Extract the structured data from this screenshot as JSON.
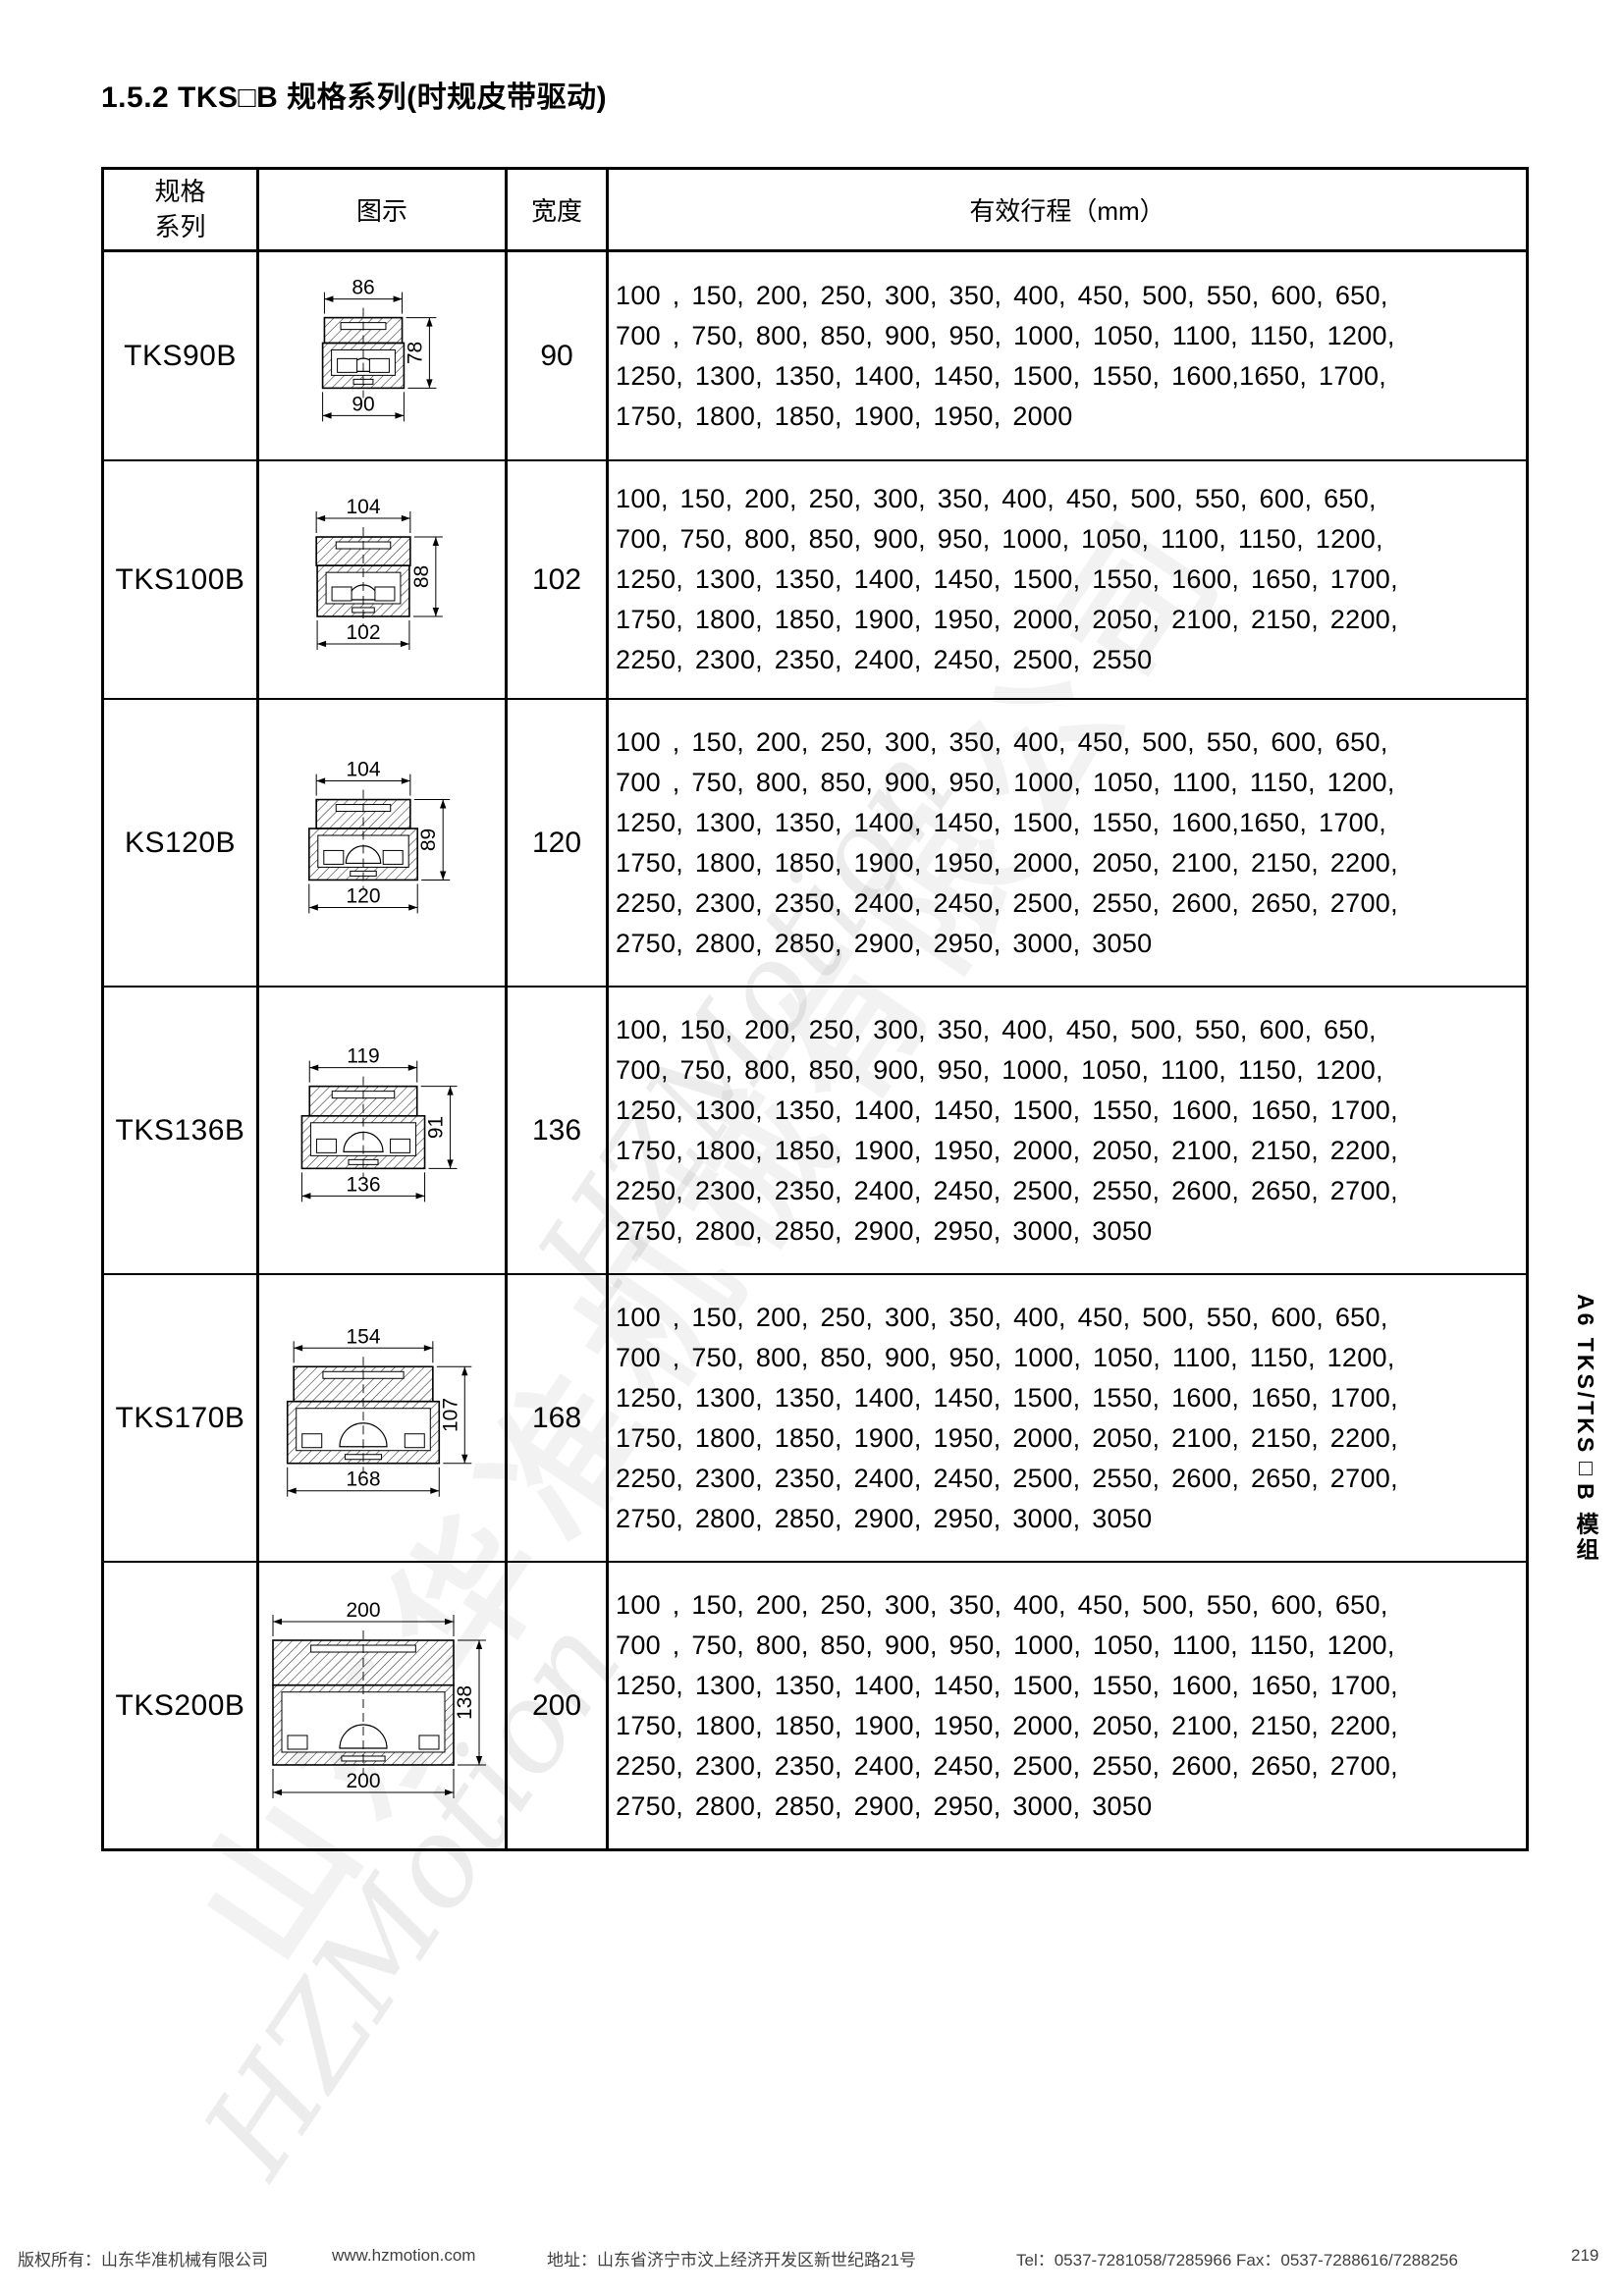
{
  "page": {
    "title": "1.5.2 TKS□B 规格系列(时规皮带驱动)",
    "sidebar_vertical_label": "A6 TKS/TKS□B 模组",
    "watermark": {
      "script_text": "HZMotion",
      "company_text": "山东华准机械有限公司"
    },
    "footer": {
      "copyright": "版权所有：山东华准机械有限公司",
      "website": "www.hzmotion.com",
      "address": "地址：山东省济宁市汶上经济开发区新世纪路21号",
      "tel_fax": "Tel：0537-7281058/7285966 Fax：0537-7288616/7288256",
      "page_number": "219"
    }
  },
  "table": {
    "headers": {
      "series": "规格\n系列",
      "diagram": "图示",
      "width": "宽度",
      "stroke": "有效行程（mm）"
    },
    "rows": [
      {
        "series": "TKS90B",
        "width": "90",
        "diagram": {
          "top_width": "86",
          "height": "78",
          "bottom_width": "90"
        },
        "stroke_lines": "100 , 150, 200, 250, 300, 350, 400, 450, 500, 550, 600, 650,\n700 , 750, 800, 850, 900, 950, 1000, 1050, 1100, 1150, 1200,\n1250, 1300, 1350, 1400, 1450, 1500, 1550, 1600,1650, 1700,\n1750, 1800, 1850, 1900, 1950, 2000"
      },
      {
        "series": "TKS100B",
        "width": "102",
        "diagram": {
          "top_width": "104",
          "height": "88",
          "bottom_width": "102"
        },
        "stroke_lines": "100, 150, 200, 250, 300, 350, 400, 450, 500, 550, 600, 650,\n700, 750, 800, 850, 900, 950, 1000, 1050, 1100, 1150, 1200,\n1250, 1300, 1350, 1400, 1450, 1500, 1550, 1600, 1650, 1700,\n1750, 1800, 1850, 1900, 1950, 2000, 2050, 2100, 2150, 2200,\n2250, 2300, 2350, 2400, 2450, 2500, 2550"
      },
      {
        "series": "KS120B",
        "width": "120",
        "diagram": {
          "top_width": "104",
          "height": "89",
          "bottom_width": "120"
        },
        "stroke_lines": "100 , 150, 200, 250, 300, 350, 400, 450, 500, 550, 600, 650,\n700 , 750, 800, 850, 900, 950, 1000, 1050, 1100, 1150, 1200,\n1250, 1300, 1350, 1400, 1450, 1500, 1550, 1600,1650, 1700,\n1750, 1800, 1850, 1900, 1950, 2000, 2050, 2100, 2150, 2200,\n2250, 2300, 2350, 2400, 2450, 2500, 2550, 2600, 2650, 2700,\n2750, 2800, 2850, 2900, 2950, 3000, 3050"
      },
      {
        "series": "TKS136B",
        "width": "136",
        "diagram": {
          "top_width": "119",
          "height": "91",
          "bottom_width": "136"
        },
        "stroke_lines": "100, 150, 200, 250, 300, 350, 400, 450, 500, 550, 600, 650,\n700, 750, 800, 850, 900, 950, 1000, 1050, 1100, 1150, 1200,\n1250, 1300, 1350, 1400, 1450, 1500, 1550, 1600, 1650, 1700,\n1750, 1800, 1850, 1900, 1950, 2000, 2050, 2100, 2150, 2200,\n2250, 2300, 2350, 2400, 2450, 2500, 2550, 2600, 2650, 2700,\n2750, 2800, 2850, 2900, 2950, 3000, 3050"
      },
      {
        "series": "TKS170B",
        "width": "168",
        "diagram": {
          "top_width": "154",
          "height": "107",
          "bottom_width": "168"
        },
        "stroke_lines": "100 , 150, 200, 250, 300, 350, 400, 450, 500, 550, 600, 650,\n700 , 750, 800, 850, 900, 950, 1000, 1050, 1100, 1150, 1200,\n1250, 1300, 1350, 1400, 1450, 1500, 1550, 1600, 1650, 1700,\n1750, 1800, 1850, 1900, 1950, 2000, 2050, 2100, 2150, 2200,\n2250, 2300, 2350, 2400, 2450, 2500, 2550, 2600, 2650, 2700,\n2750, 2800, 2850, 2900, 2950, 3000, 3050"
      },
      {
        "series": "TKS200B",
        "width": "200",
        "diagram": {
          "top_width": "200",
          "height": "138",
          "bottom_width": "200"
        },
        "stroke_lines": "100 , 150, 200, 250, 300, 350, 400, 450, 500, 550, 600, 650,\n700 , 750, 800, 850, 900, 950, 1000, 1050, 1100, 1150, 1200,\n1250, 1300, 1350, 1400, 1450, 1500, 1550, 1600, 1650, 1700,\n1750, 1800, 1850, 1900, 1950, 2000, 2050, 2100, 2150, 2200,\n2250, 2300, 2350, 2400, 2450, 2500, 2550, 2600, 2650, 2700,\n2750, 2800, 2850, 2900, 2950, 3000, 3050"
      }
    ]
  }
}
